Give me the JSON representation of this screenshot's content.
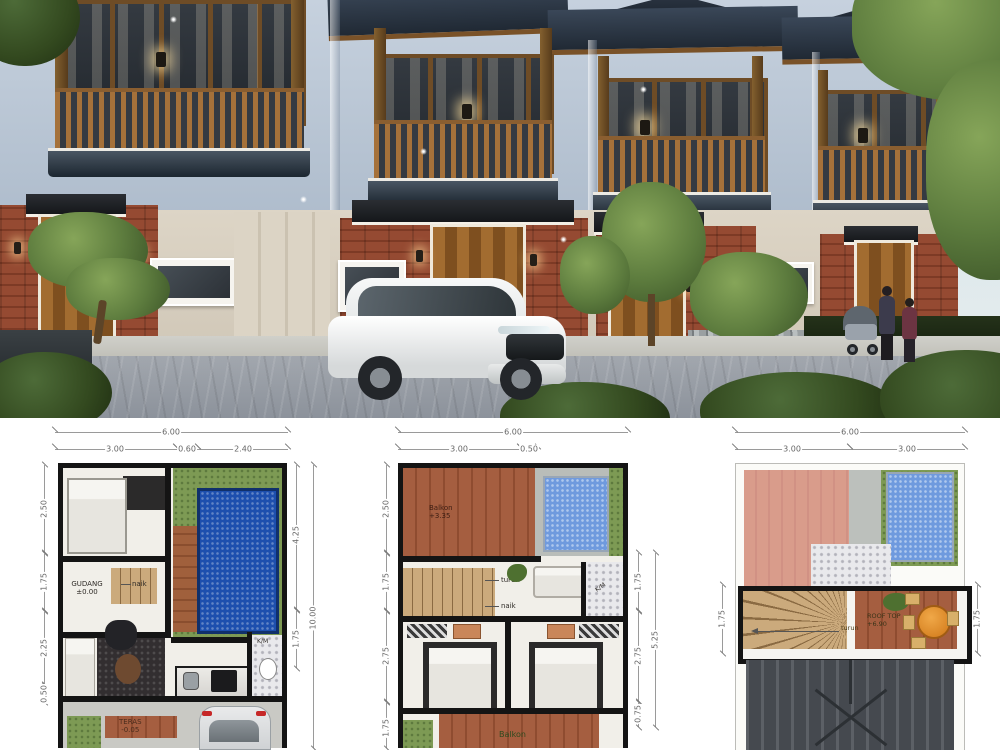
{
  "colors": {
    "roof_slate": "#2c3642",
    "upper_wall": "#b7c4d3",
    "brick": "#8d4530",
    "wood_trim": "#8a5e30",
    "pool_blue": "#1d4fae",
    "plan_wall": "#141414",
    "deck_wood": "#9a5c38"
  },
  "floor_plans": [
    {
      "id": "ground-floor",
      "top": {
        "overall": "6.00",
        "segments": [
          "3.00",
          "0.60",
          "2.40"
        ]
      },
      "left": [
        "2.50",
        "1.75",
        "2.25",
        "0.50"
      ],
      "right": [
        "4.25",
        "1.75"
      ],
      "right_overall": "10.00",
      "labels": {
        "gudang": "GUDANG",
        "gudang_level": "±0.00",
        "stairs_up": "naik",
        "bath": "K/M",
        "teras": "TERAS",
        "teras_level": "-0.05"
      }
    },
    {
      "id": "upper-floor",
      "top": {
        "overall": "6.00",
        "segments": [
          "3.00",
          "0.50"
        ]
      },
      "left": [
        "2.50",
        "1.75",
        "2.75",
        "1.75"
      ],
      "right": [
        "1.75",
        "2.75",
        "0.75"
      ],
      "right_overall": "5.25",
      "labels": {
        "balkon": "Balkon",
        "balkon_level": "+3.35",
        "stairs_down": "turun",
        "stairs_up": "naik",
        "bath": "K/M",
        "balkon_bottom": "Balkon"
      }
    },
    {
      "id": "rooftop",
      "top": {
        "overall": "6.00",
        "segments": [
          "3.00",
          "3.00"
        ]
      },
      "left": [
        "1.75"
      ],
      "right": [
        "1.75"
      ],
      "labels": {
        "rooftop": "ROOF TOP",
        "rooftop_level": "+6.90",
        "stairs_down": "turun"
      }
    }
  ]
}
